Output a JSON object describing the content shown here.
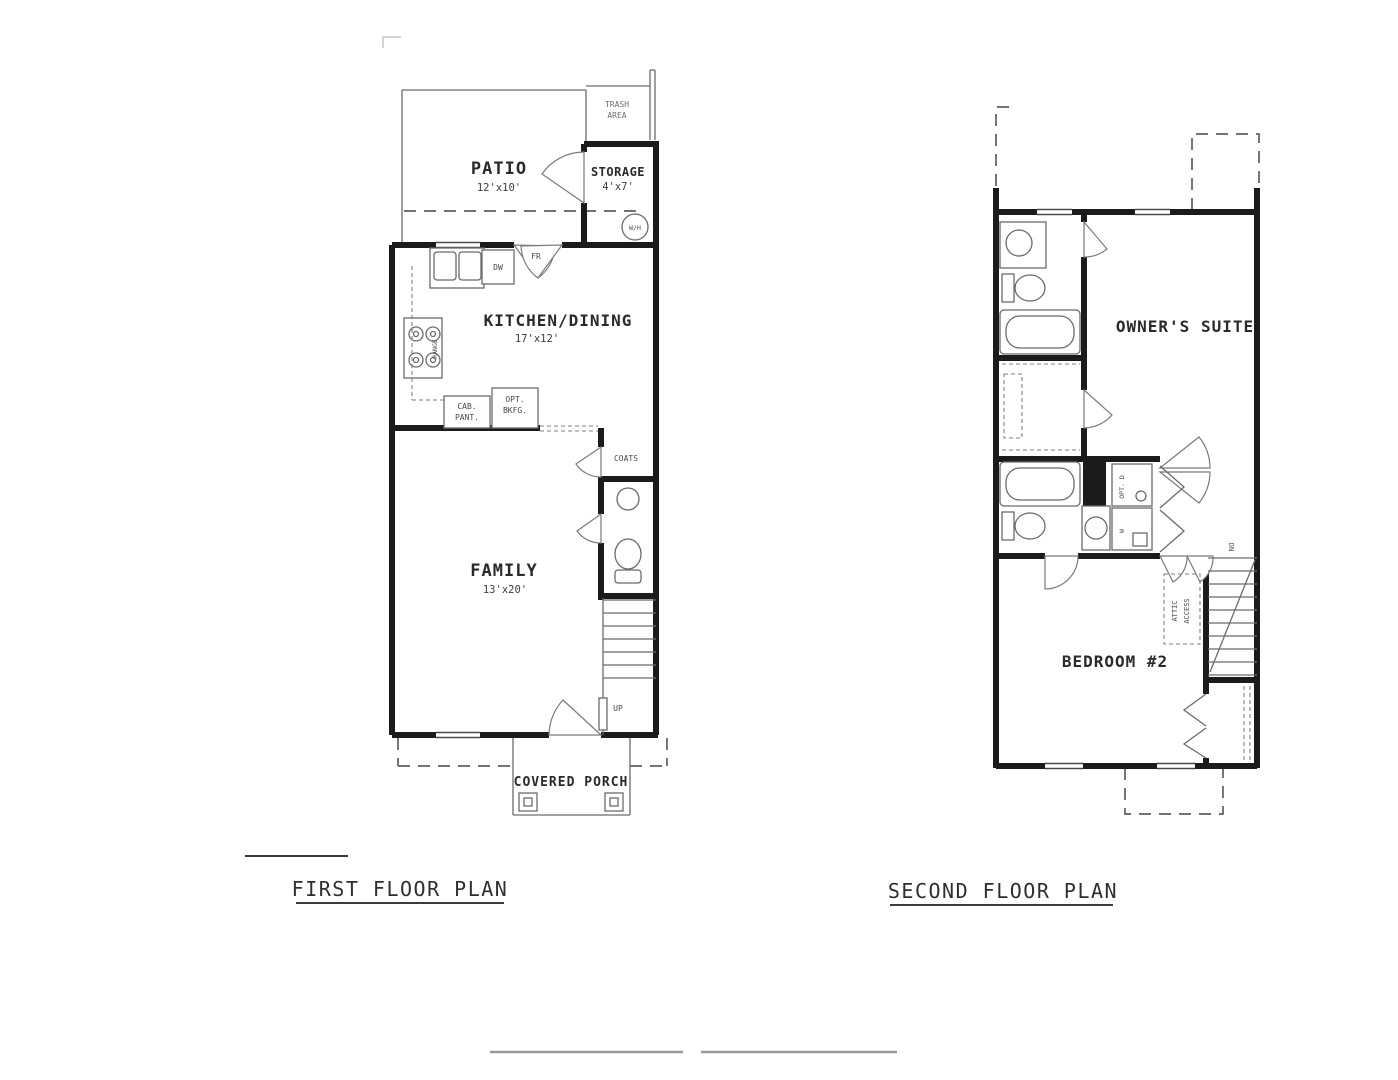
{
  "first_floor": {
    "title": "FIRST FLOOR PLAN",
    "patio": {
      "name": "PATIO",
      "dims": "12'x10'"
    },
    "trash": {
      "line1": "TRASH",
      "line2": "AREA"
    },
    "storage": {
      "name": "STORAGE",
      "dims": "4'x7'"
    },
    "water_heater_label": "W/H",
    "kitchen": {
      "name": "KITCHEN/DINING",
      "dims": "17'x12'"
    },
    "french_door_label": "FR",
    "dishwasher_label": "DW",
    "range_label": "RANGE",
    "cab_pantry": {
      "line1": "CAB.",
      "line2": "PANT."
    },
    "opt_bkfg": {
      "line1": "OPT.",
      "line2": "BKFG."
    },
    "coats_label": "COATS",
    "family": {
      "name": "FAMILY",
      "dims": "13'x20'"
    },
    "up_label": "UP",
    "porch_label": "COVERED PORCH"
  },
  "second_floor": {
    "title": "SECOND FLOOR PLAN",
    "owners_suite_label": "OWNER'S SUITE",
    "bedroom2_label": "BEDROOM #2",
    "attic": {
      "line1": "ATTIC",
      "line2": "ACCESS"
    },
    "dn_label": "DN",
    "opt_dryer_label": "OPT. D",
    "washer_label": "W"
  }
}
